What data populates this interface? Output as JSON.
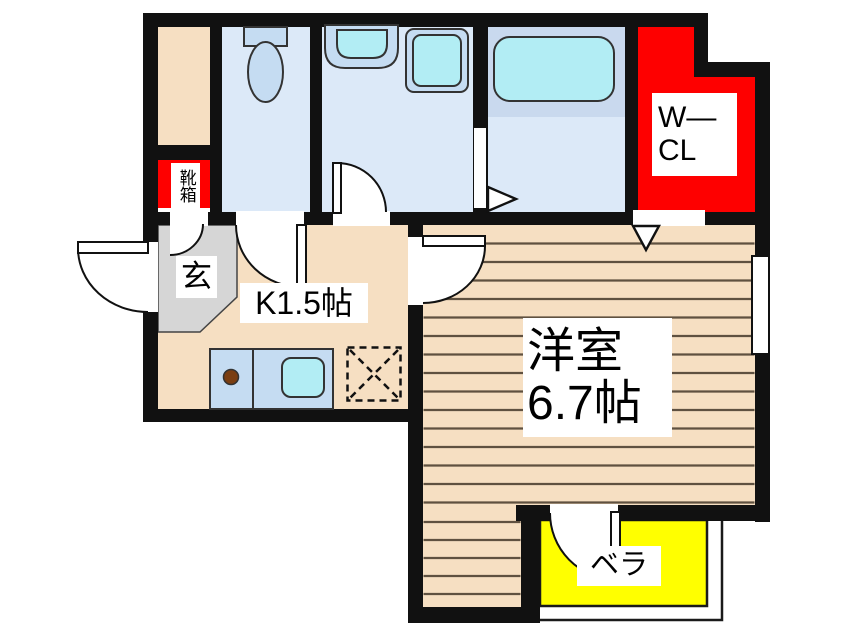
{
  "rooms": {
    "shoe_box": {
      "label": "靴箱"
    },
    "entrance": {
      "label": "玄"
    },
    "kitchen": {
      "label": "K1.5帖"
    },
    "western_room": {
      "name": "洋室",
      "size": "6.7帖"
    },
    "walk_in_closet": {
      "line1": "W—",
      "line2": "CL"
    },
    "veranda": {
      "label": "ベラ"
    }
  },
  "colors": {
    "wall": "#111111",
    "floor": "#f6dfc2",
    "plank_line": "#5f5140",
    "room_blue": "#dce9f8",
    "fixture_blue": "#c5dcf2",
    "cyan": "#b2edf4",
    "bath_band": "#c9d9ee",
    "red": "#fe0000",
    "yellow": "#ffff00",
    "gray": "#d6d6d6"
  }
}
